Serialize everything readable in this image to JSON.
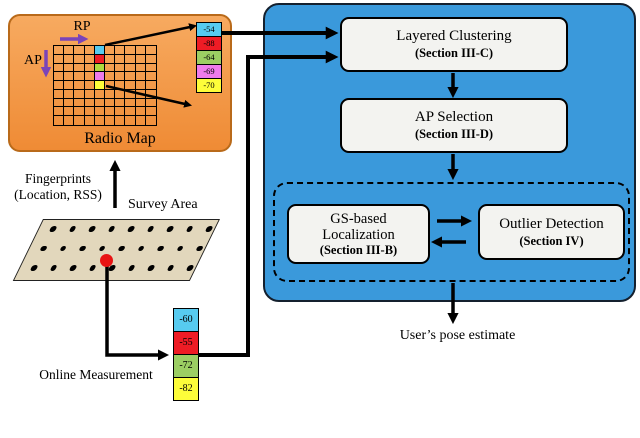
{
  "radio_map": {
    "title": "Radio Map",
    "rp_label": "RP",
    "ap_label": "AP",
    "grid": {
      "cols": 10,
      "rows": 9,
      "colored_col": 4,
      "colored_cells": [
        "#57CBF0",
        "#EE1C25",
        "#AFDA3E",
        "#EE7BEB",
        "#FDFD3A"
      ]
    }
  },
  "fingerprint_vector": {
    "cells": [
      {
        "value": "-54",
        "color": "#57CBF0"
      },
      {
        "value": "-88",
        "color": "#EE1C25"
      },
      {
        "value": "-64",
        "color": "#9CCE63"
      },
      {
        "value": "-69",
        "color": "#EE7BEB"
      },
      {
        "value": "-70",
        "color": "#FDFD3A"
      }
    ]
  },
  "online_vector": {
    "cells": [
      {
        "value": "-60",
        "color": "#57CBF0"
      },
      {
        "value": "-55",
        "color": "#EE1C25"
      },
      {
        "value": "-72",
        "color": "#9CCE63"
      },
      {
        "value": "-82",
        "color": "#FDFD3A"
      }
    ]
  },
  "survey_area": {
    "label": "Survey Area",
    "dot_rows": 3,
    "dots_per_row": 9
  },
  "labels": {
    "fingerprints_line1": "Fingerprints",
    "fingerprints_line2": "(Location, RSS)",
    "online_measurement": "Online Measurement",
    "users_pose_estimate": "User’s pose estimate"
  },
  "pipeline": {
    "layered_clustering": {
      "title": "Layered Clustering",
      "subtitle": "(Section III-C)"
    },
    "ap_selection": {
      "title": "AP Selection",
      "subtitle": "(Section III-D)"
    },
    "gs_localization": {
      "line1": "GS-based",
      "line2": "Localization",
      "subtitle": "(Section III-B)"
    },
    "outlier_detection": {
      "title": "Outlier Detection",
      "subtitle": "(Section IV)"
    }
  },
  "colors": {
    "orange_fill_top": "#F7AA60",
    "orange_fill_bottom": "#EF8B35",
    "orange_border": "#B96A1A",
    "blue_fill": "#3A99DB",
    "blue_border": "#14202E",
    "box_fill": "#F3F3F0",
    "parallelogram_fill": "#E2D7BC",
    "arrow_color": "#000000",
    "purple": "#7B44B8"
  }
}
